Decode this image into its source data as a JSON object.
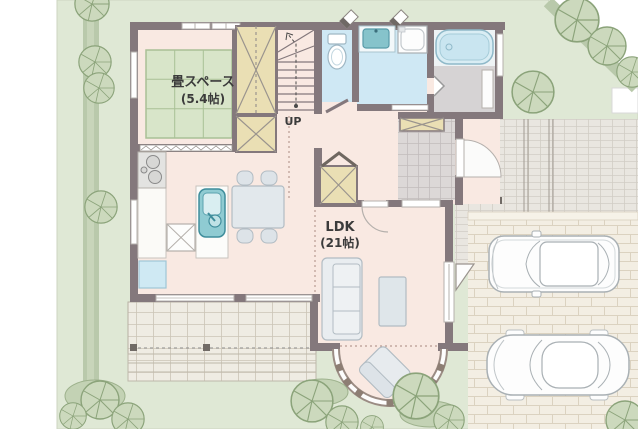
{
  "plan": {
    "rooms": {
      "tatami": {
        "label": "畳スペース",
        "size_label": "(5.4帖)"
      },
      "ldk": {
        "label": "LDK",
        "size_label": "(21帖)"
      },
      "stairs": {
        "direction_label": "UP"
      }
    }
  },
  "colors": {
    "lawn": "#dfe8d5",
    "hedge": "#b9c9ab",
    "floor_pink": "#f9e9e2",
    "tatami_green": "#d8e5c9",
    "wall_gray": "#84787c",
    "water_blue": "#cfe8f4",
    "closet_tan": "#eadfb4",
    "driveway_brick": "#f3eee3",
    "terrace_tile": "#efece3",
    "entrance_tile": "#dcd8d7",
    "furniture_gray": "#e7ebee",
    "sink_teal": "#8fcbd2"
  }
}
